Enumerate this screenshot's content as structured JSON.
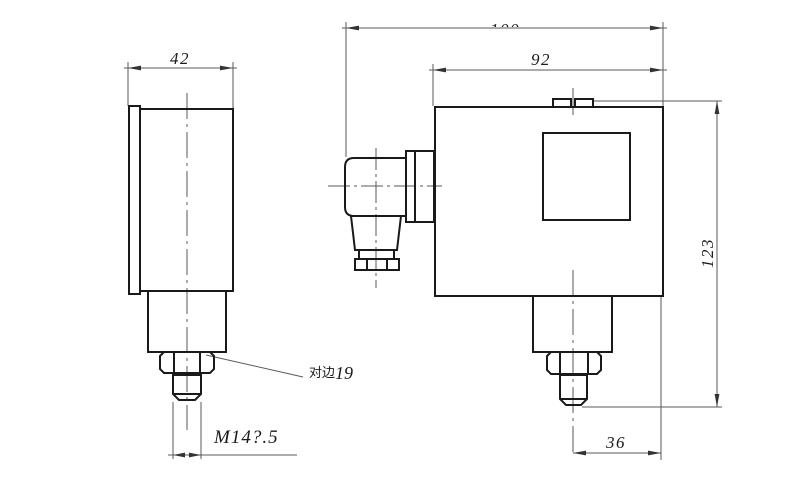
{
  "drawing": {
    "background": "#ffffff",
    "outline_color": "#1a1a1a",
    "dim_color": "#5a5a5a",
    "views": {
      "side": {
        "dimensions": {
          "width": "42",
          "thread": "M14?.5",
          "nut_across_flats_label": "对边",
          "nut_across_flats_value": "19"
        }
      },
      "front": {
        "dimensions": {
          "overall_width": "100",
          "body_width": "92",
          "overall_height": "123",
          "port_offset": "36"
        }
      }
    }
  }
}
